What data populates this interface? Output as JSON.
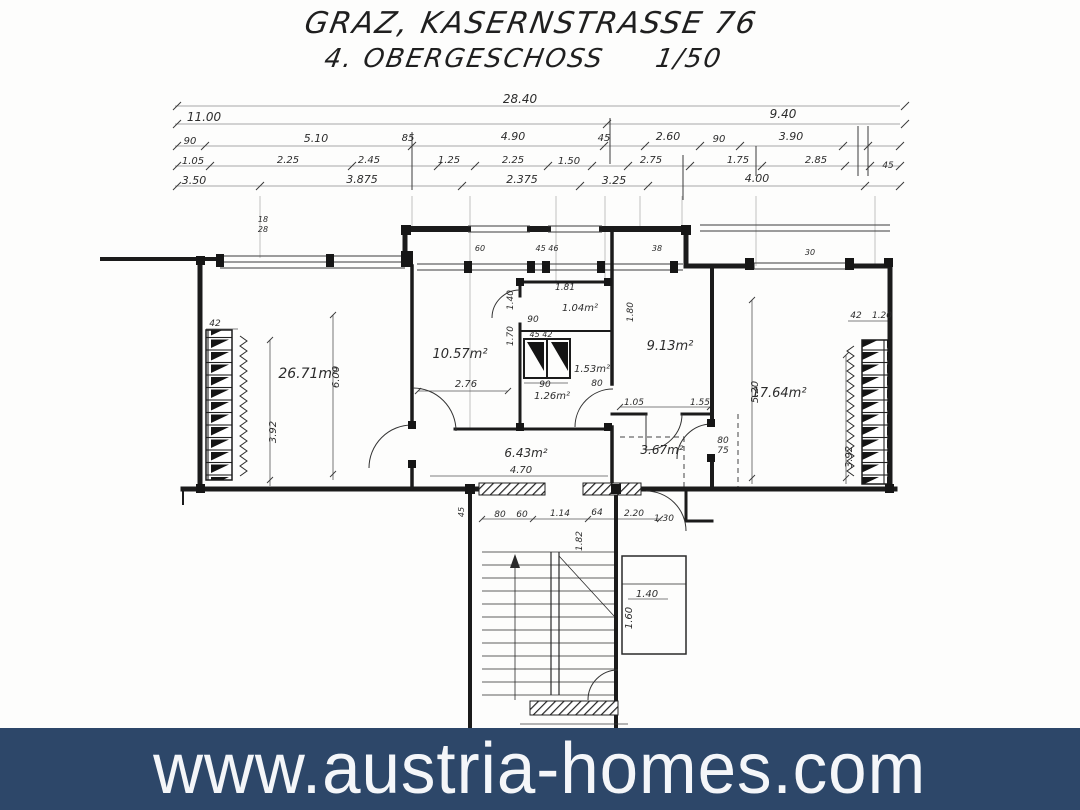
{
  "title": {
    "location": "GRAZ, KASERNSTRASSE 76",
    "floor": "4. OBERGESCHOSS",
    "scale": "1/50"
  },
  "banner": {
    "url": "www.austria-homes.com",
    "bg_color": "#2d4769",
    "text_color": "#f4f6f9"
  },
  "plan": {
    "labels": [
      {
        "n": "dim-total-width",
        "t": "28.40",
        "x": 520,
        "y": 103,
        "s": 12
      },
      {
        "n": "dim-left-wing",
        "t": "11.00",
        "x": 204,
        "y": 121,
        "s": 12
      },
      {
        "n": "dim-right-wing",
        "t": "9.40",
        "x": 783,
        "y": 118,
        "s": 12
      },
      {
        "n": "dim",
        "t": "90",
        "x": 190,
        "y": 144,
        "s": 10
      },
      {
        "n": "dim",
        "t": "5.10",
        "x": 316,
        "y": 142,
        "s": 11
      },
      {
        "n": "dim",
        "t": "85",
        "x": 408,
        "y": 141,
        "s": 10
      },
      {
        "n": "dim",
        "t": "4.90",
        "x": 513,
        "y": 140,
        "s": 11
      },
      {
        "n": "dim",
        "t": "45",
        "x": 604,
        "y": 141,
        "s": 10
      },
      {
        "n": "dim",
        "t": "2.60",
        "x": 668,
        "y": 140,
        "s": 11
      },
      {
        "n": "dim",
        "t": "90",
        "x": 719,
        "y": 142,
        "s": 10
      },
      {
        "n": "dim",
        "t": "3.90",
        "x": 791,
        "y": 140,
        "s": 11
      },
      {
        "n": "dim",
        "t": "1.05",
        "x": 193,
        "y": 164,
        "s": 10
      },
      {
        "n": "dim",
        "t": "2.25",
        "x": 288,
        "y": 163,
        "s": 10
      },
      {
        "n": "dim",
        "t": "2.45",
        "x": 369,
        "y": 163,
        "s": 10
      },
      {
        "n": "dim",
        "t": "1.25",
        "x": 449,
        "y": 163,
        "s": 10
      },
      {
        "n": "dim",
        "t": "2.25",
        "x": 513,
        "y": 163,
        "s": 10
      },
      {
        "n": "dim",
        "t": "1.50",
        "x": 569,
        "y": 164,
        "s": 10
      },
      {
        "n": "dim",
        "t": "2.75",
        "x": 651,
        "y": 163,
        "s": 10
      },
      {
        "n": "dim",
        "t": "1.75",
        "x": 738,
        "y": 163,
        "s": 10
      },
      {
        "n": "dim",
        "t": "2.85",
        "x": 816,
        "y": 163,
        "s": 10
      },
      {
        "n": "dim",
        "t": "45",
        "x": 888,
        "y": 168,
        "s": 9
      },
      {
        "n": "dim",
        "t": "3.50",
        "x": 194,
        "y": 184,
        "s": 11
      },
      {
        "n": "dim",
        "t": "3.875",
        "x": 362,
        "y": 183,
        "s": 11
      },
      {
        "n": "dim",
        "t": "2.375",
        "x": 522,
        "y": 183,
        "s": 11
      },
      {
        "n": "dim",
        "t": "3.25",
        "x": 614,
        "y": 184,
        "s": 11
      },
      {
        "n": "dim",
        "t": "4.00",
        "x": 757,
        "y": 182,
        "s": 11
      },
      {
        "n": "room-area-living",
        "t": "26.71m²",
        "x": 308,
        "y": 378,
        "s": 14
      },
      {
        "n": "room-area-cabinet",
        "t": "10.57m²",
        "x": 460,
        "y": 358,
        "s": 13
      },
      {
        "n": "room-area-wc",
        "t": "1.04m²",
        "x": 580,
        "y": 311,
        "s": 10
      },
      {
        "n": "room-area-shaft",
        "t": "1.53m²",
        "x": 592,
        "y": 372,
        "s": 10
      },
      {
        "n": "room-area-vestibule",
        "t": "1.26m²",
        "x": 552,
        "y": 399,
        "s": 10
      },
      {
        "n": "room-area-bedroom",
        "t": "9.13m²",
        "x": 670,
        "y": 350,
        "s": 13
      },
      {
        "n": "room-area-bath",
        "t": "3.67m²",
        "x": 662,
        "y": 454,
        "s": 12
      },
      {
        "n": "room-area-hall",
        "t": "6.43m²",
        "x": 526,
        "y": 457,
        "s": 12
      },
      {
        "n": "dim",
        "t": "4.70",
        "x": 521,
        "y": 473,
        "s": 10
      },
      {
        "n": "room-area-right",
        "t": "17.64m²",
        "x": 779,
        "y": 397,
        "s": 13
      },
      {
        "n": "dim",
        "t": "2.76",
        "x": 466,
        "y": 387,
        "s": 10
      },
      {
        "n": "dim",
        "t": "90",
        "x": 545,
        "y": 387,
        "s": 9
      },
      {
        "n": "dim",
        "t": "80",
        "x": 597,
        "y": 386,
        "s": 9
      },
      {
        "n": "dim",
        "t": "1.81",
        "x": 565,
        "y": 290,
        "s": 9
      },
      {
        "n": "dim",
        "t": "90",
        "x": 533,
        "y": 322,
        "s": 9
      },
      {
        "n": "dim",
        "t": "45 42",
        "x": 541,
        "y": 337,
        "s": 8
      },
      {
        "n": "dim",
        "t": "42",
        "x": 215,
        "y": 326,
        "s": 9
      },
      {
        "n": "dim",
        "t": "42",
        "x": 856,
        "y": 318,
        "s": 9
      },
      {
        "n": "dim",
        "t": "1.20",
        "x": 882,
        "y": 318,
        "s": 9
      },
      {
        "n": "dim",
        "t": "1.05",
        "x": 634,
        "y": 405,
        "s": 9
      },
      {
        "n": "dim",
        "t": "1.55",
        "x": 700,
        "y": 405,
        "s": 9
      },
      {
        "n": "dim",
        "t": "80",
        "x": 723,
        "y": 443,
        "s": 9
      },
      {
        "n": "dim",
        "t": "75",
        "x": 723,
        "y": 453,
        "s": 9
      },
      {
        "n": "dim",
        "t": "80",
        "x": 500,
        "y": 517,
        "s": 9
      },
      {
        "n": "dim",
        "t": "60",
        "x": 522,
        "y": 517,
        "s": 9
      },
      {
        "n": "dim",
        "t": "1.14",
        "x": 560,
        "y": 516,
        "s": 9
      },
      {
        "n": "dim",
        "t": "64",
        "x": 597,
        "y": 515,
        "s": 9
      },
      {
        "n": "dim",
        "t": "2.20",
        "x": 634,
        "y": 516,
        "s": 9
      },
      {
        "n": "dim",
        "t": "1.30",
        "x": 664,
        "y": 521,
        "s": 9
      },
      {
        "n": "dim",
        "t": "1.40",
        "x": 647,
        "y": 597,
        "s": 10
      },
      {
        "n": "dim",
        "t": "60",
        "x": 480,
        "y": 251,
        "s": 8
      },
      {
        "n": "dim",
        "t": "45 46",
        "x": 547,
        "y": 251,
        "s": 8
      },
      {
        "n": "dim",
        "t": "38",
        "x": 657,
        "y": 251,
        "s": 8
      },
      {
        "n": "dim",
        "t": "30",
        "x": 810,
        "y": 255,
        "s": 8
      },
      {
        "n": "dim",
        "t": "18",
        "x": 263,
        "y": 222,
        "s": 8
      },
      {
        "n": "dim",
        "t": "28",
        "x": 263,
        "y": 232,
        "s": 8
      },
      {
        "n": "dim",
        "t": "6.00",
        "x": 339,
        "y": 377,
        "s": 10,
        "r": -90
      },
      {
        "n": "dim",
        "t": "3.92",
        "x": 276,
        "y": 432,
        "s": 10,
        "r": -90
      },
      {
        "n": "dim",
        "t": "5.20",
        "x": 758,
        "y": 392,
        "s": 10,
        "r": -90
      },
      {
        "n": "dim",
        "t": "3.92",
        "x": 852,
        "y": 457,
        "s": 10,
        "r": -90
      },
      {
        "n": "dim",
        "t": "1.60",
        "x": 632,
        "y": 618,
        "s": 10,
        "r": -90
      },
      {
        "n": "dim",
        "t": "1.82",
        "x": 582,
        "y": 541,
        "s": 9,
        "r": -90
      },
      {
        "n": "dim",
        "t": "1.70",
        "x": 513,
        "y": 336,
        "s": 9,
        "r": -90
      },
      {
        "n": "dim",
        "t": "1.40",
        "x": 513,
        "y": 300,
        "s": 9,
        "r": -90
      },
      {
        "n": "dim",
        "t": "1.80",
        "x": 633,
        "y": 312,
        "s": 9,
        "r": -90
      },
      {
        "n": "dim",
        "t": "45",
        "x": 464,
        "y": 512,
        "s": 8,
        "r": -90
      }
    ]
  }
}
